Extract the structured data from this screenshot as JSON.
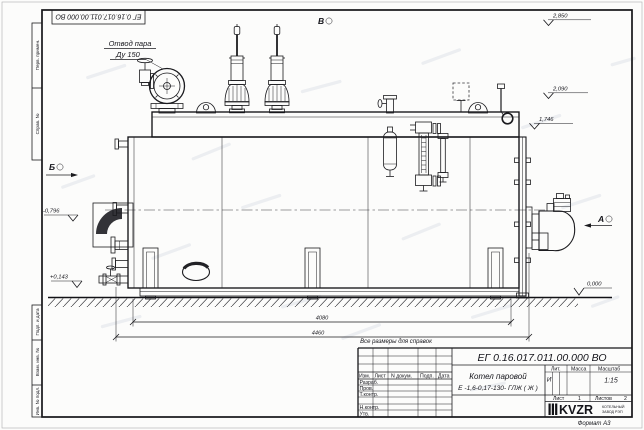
{
  "sheet": {
    "doc_number": "ЕГ 0.16.017.011.00.000  ВО",
    "format_label": "Формат А3",
    "margin_cells": {
      "perv_primen": "Перв. примен.",
      "sprav_no": "Справ. №",
      "podp_data": "Подп. и дата",
      "vzam_inv": "Взам. инв. №",
      "inv_podl": "Инв. № подл."
    }
  },
  "annotations": {
    "steam_outlet_line1": "Отвод пара",
    "steam_outlet_line2": "Ду 150",
    "view_a": "А",
    "view_b": "Б",
    "view_v": "В",
    "reference_note": "Все размеры для справок"
  },
  "elevations": {
    "top": "2,850",
    "upper": "2,090",
    "deck": "1,746",
    "left_upper": "-0,796",
    "left_lower": "+0,143",
    "ground": "0,000"
  },
  "dimensions": {
    "inner_length": "4080",
    "overall_length": "4460"
  },
  "title_block": {
    "doc_number": "ЕГ 0.16.017.011.00.000  ВО",
    "product_name": "Котел паровой",
    "product_code": "Е -1,6-0,17-130- ГЛЖ ( Ж )",
    "col_izm": "Изм.",
    "col_list": "Лист",
    "col_ndoc": "N докум.",
    "col_podp": "Подп.",
    "col_data": "Дата",
    "row_razrab": "Разраб.",
    "row_prov": "Пров.",
    "row_tkontr": "Т.контр.",
    "row_nkontr": "Н.контр.",
    "row_utv": "Утв.",
    "lit_header": "Лит.",
    "mass_header": "Масса",
    "scale_header": "Масштаб",
    "lit_value": "И",
    "scale_value": "1:15",
    "sheet_label": "Лист",
    "sheet_value": "1",
    "sheets_label": "Листов",
    "sheets_value": "2",
    "logo_text": "KVZR",
    "logo_line1": "КОТЕЛЬНЫЙ",
    "logo_line2": "ЗАВОД РЭП"
  }
}
